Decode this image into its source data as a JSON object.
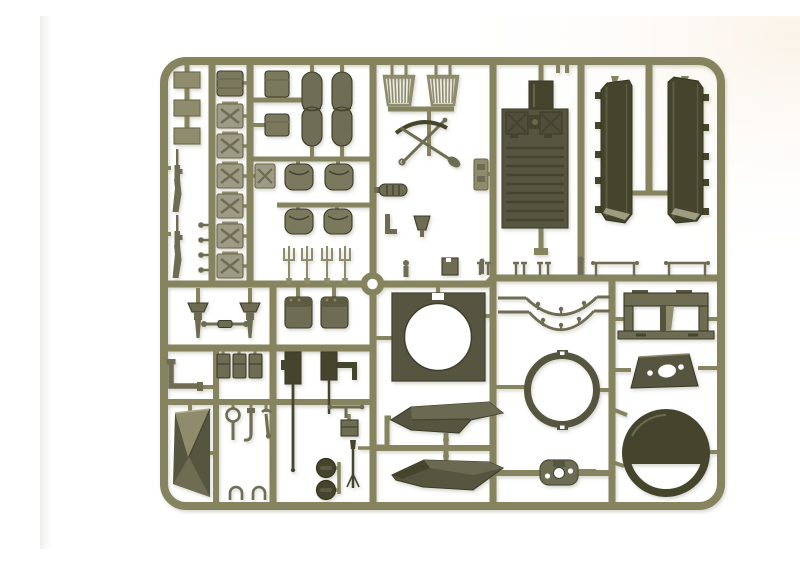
{
  "scene": {
    "description": "Photograph of an olive-drab injection-molded model kit sprue (parts tree) with military vehicle accessory parts, on a plain white background",
    "background_color": "#ffffff"
  },
  "palette": {
    "bg": "#ffffff",
    "bg_edge": "#efefed",
    "runner": "#86835f",
    "runner_dark": "#6b6846",
    "part_light": "#9d9b86",
    "part_mid": "#8e8c6c",
    "part_middark": "#6e6c52",
    "part_dark": "#575640",
    "part_darkest": "#45442f",
    "bag": "#7a785d",
    "duffel": "#6f6d55",
    "hl": "#aeac8f",
    "brass": "#9a833f"
  },
  "sprue": {
    "material": "olive drab styrene",
    "parts_inventory": [
      {
        "id": "small-plate",
        "label": "small mounting plate",
        "count": 3
      },
      {
        "id": "rifle",
        "label": "rifle",
        "count": 2
      },
      {
        "id": "mounting-pin",
        "label": "mounting pin",
        "count": 4
      },
      {
        "id": "jerry-can",
        "label": "jerry can with X emboss",
        "count": 7
      },
      {
        "id": "stowage-pack",
        "label": "stowage pack",
        "count": 4
      },
      {
        "id": "duffel-bag",
        "label": "duffel bag",
        "count": 2
      },
      {
        "id": "stowage-bag",
        "label": "stowage bag",
        "count": 4
      },
      {
        "id": "pitchfork",
        "label": "pitchfork",
        "count": 4
      },
      {
        "id": "slat-grille",
        "label": "slatted grille basket",
        "count": 2
      },
      {
        "id": "pioneer-tools",
        "label": "crossed pick and shovel",
        "count": 1
      },
      {
        "id": "engine-deck",
        "label": "engine deck with hatches",
        "count": 1
      },
      {
        "id": "fender",
        "label": "long side fender",
        "count": 2
      },
      {
        "id": "tow-rail",
        "label": "tow rail",
        "count": 2
      },
      {
        "id": "rigging-clamp",
        "label": "rigging clamp",
        "count": 6
      },
      {
        "id": "turret-plate",
        "label": "square plate with round opening",
        "count": 1
      },
      {
        "id": "grab-rail",
        "label": "curved grab rail",
        "count": 2
      },
      {
        "id": "periscope-bracket",
        "label": "twin periscope guard bracket",
        "count": 1
      },
      {
        "id": "turret-ring",
        "label": "turret ring",
        "count": 1
      },
      {
        "id": "glacis-plate",
        "label": "glacis plate with MG opening",
        "count": 1
      },
      {
        "id": "hatch-ring",
        "label": "hatch ring with splash guard",
        "count": 1
      },
      {
        "id": "base-plate",
        "label": "base plate with openings",
        "count": 1
      },
      {
        "id": "mud-scoop",
        "label": "mudguard scoop",
        "count": 2
      },
      {
        "id": "machine-gun",
        "label": "machine gun",
        "count": 2
      },
      {
        "id": "light-mg",
        "label": "light machine gun",
        "count": 1
      },
      {
        "id": "road-wheel",
        "label": "road wheel",
        "count": 2
      },
      {
        "id": "tarpaulin",
        "label": "folded tarpaulin",
        "count": 1
      },
      {
        "id": "periscope",
        "label": "periscope",
        "count": 2
      },
      {
        "id": "tow-cable",
        "label": "tow cable",
        "count": 1
      },
      {
        "id": "elbow-pipe",
        "label": "exhaust elbow pipe",
        "count": 1
      },
      {
        "id": "ammo-box",
        "label": "ammunition box",
        "count": 3
      },
      {
        "id": "mirror",
        "label": "inspection mirror",
        "count": 1
      },
      {
        "id": "wrench",
        "label": "wrench",
        "count": 1
      },
      {
        "id": "footman-loop",
        "label": "footman loop",
        "count": 2
      },
      {
        "id": "center-ring",
        "label": "runner center ring",
        "count": 1
      }
    ]
  }
}
